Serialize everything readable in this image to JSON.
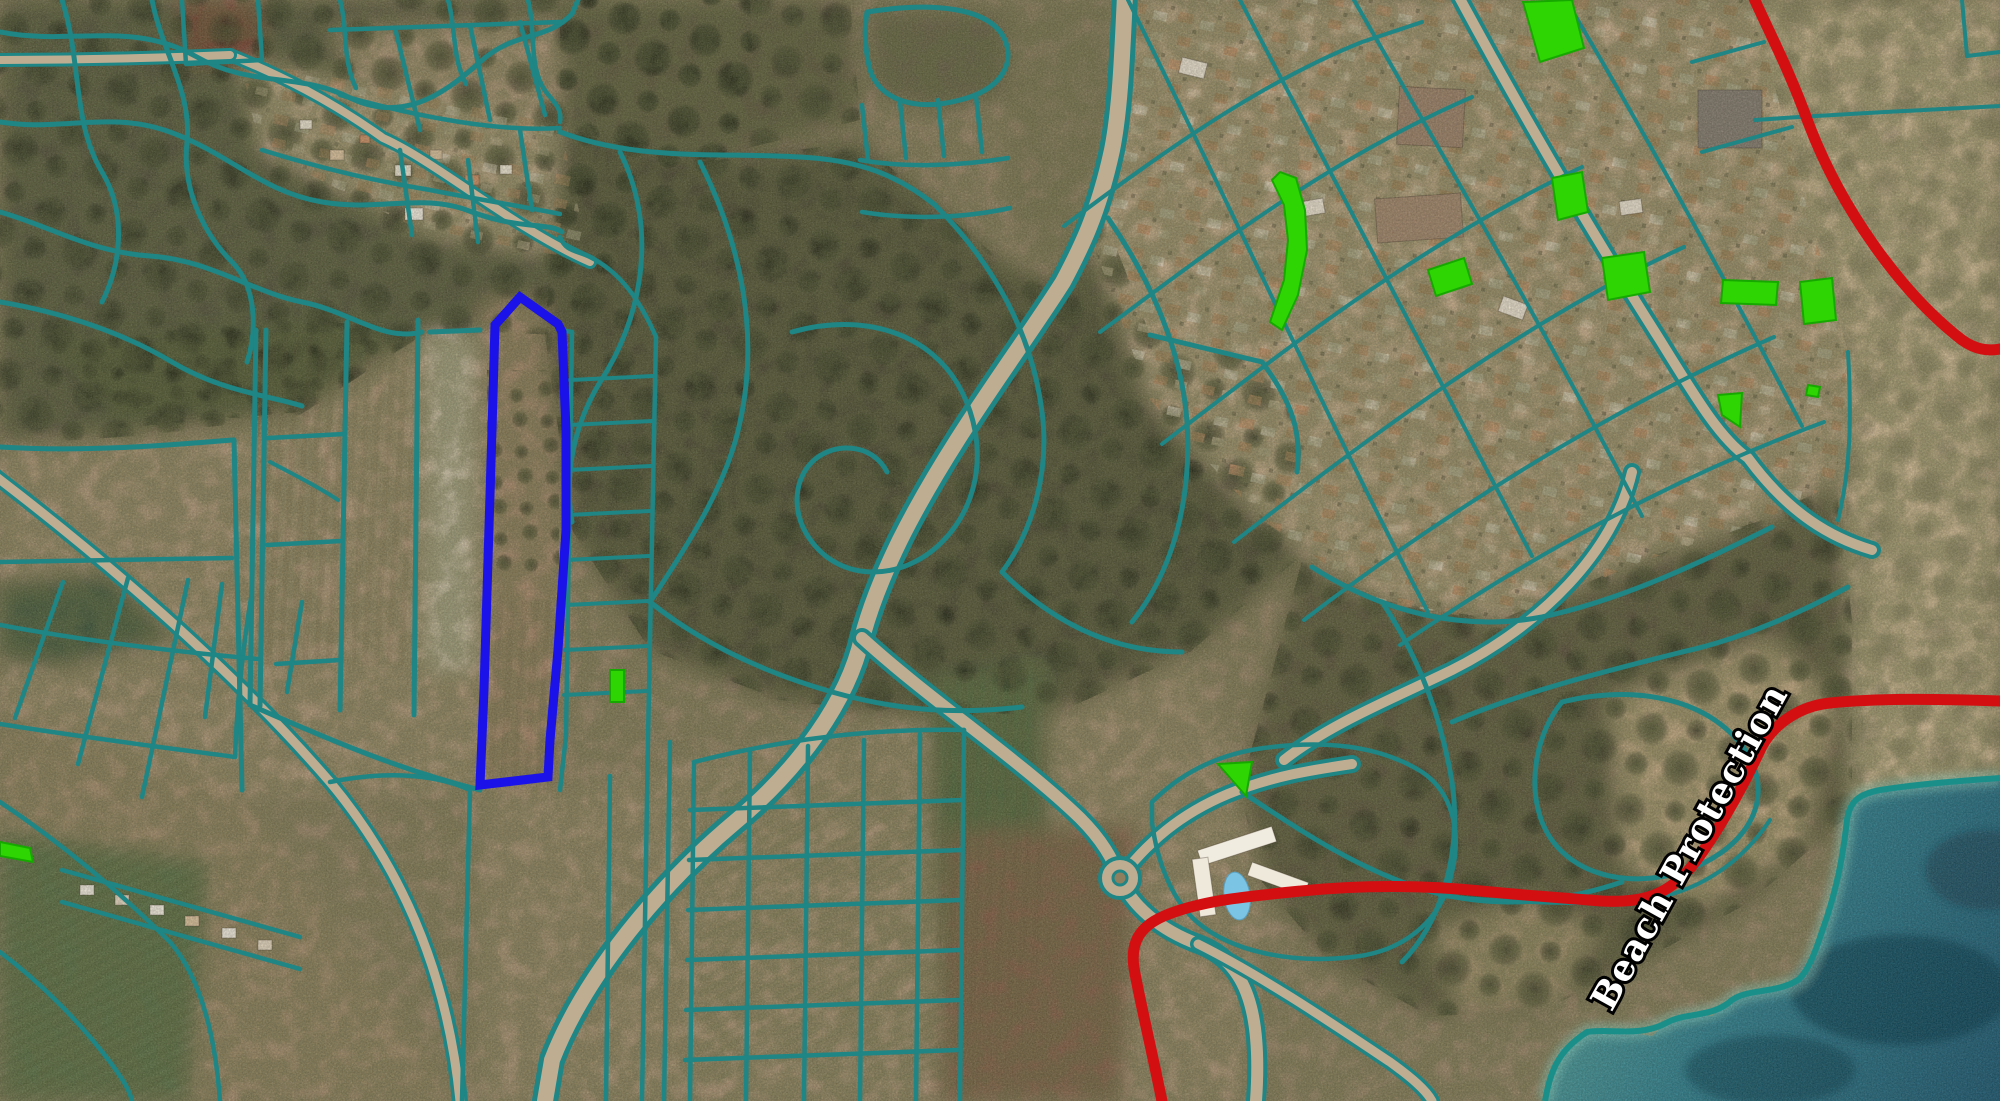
{
  "map": {
    "type": "cadastral-satellite-view",
    "labels": [
      {
        "text": "Beach Protection",
        "color": "#ffffff",
        "outline": "#000000",
        "rotation_deg": -61
      }
    ],
    "colors": {
      "parcel_boundary": "#1f8585",
      "selected_parcel_outline": "#1a12e8",
      "highlight_parcel_fill": "#2ed503",
      "highlight_parcel_stroke": "#17a800",
      "protection_line": "#d40f12",
      "sea_shallow": "#5aa89e",
      "sea_deep": "#1c5870",
      "road_fill": "#bfad92"
    },
    "selected_parcel": {
      "points": "520,297 558,324 562,332 566,430 566,530 558,650 550,740 548,777 480,785 484,690 488,560 492,430 495,325"
    },
    "green_parcels": [
      "1523,2 1572,0 1584,48 1540,62",
      "1280,172 1296,178 1305,210 1307,250 1298,295 1282,330 1270,322 1284,280 1288,240 1284,205 1272,180",
      "1552,178 1582,172 1588,212 1558,220",
      "1428,270 1464,258 1472,284 1436,296",
      "1602,258 1644,252 1650,292 1608,300",
      "1723,280 1778,282 1776,305 1721,303",
      "1800,282 1832,278 1836,320 1804,324",
      "1718,395 1742,393 1740,427 1722,415",
      "1808,385 1820,387 1818,397 1806,395",
      "1218,764 1252,762 1246,796",
      "610,670 624,670 624,702 610,702",
      "0,842 30,848 33,862 0,856"
    ],
    "protection_line": {
      "paths": [
        "M1752,-6 C1772,38 1790,72 1808,122 C1840,207 1900,292 1962,340 C1976,350 1988,351 2000,349",
        "M1163,1106 C1150,1042 1140,1002 1134,968 C1130,941 1141,926 1164,916 C1200,901 1241,897 1301,891 C1361,885 1421,885 1481,891 C1521,895 1561,898 1601,901 C1641,903 1669,897 1696,861 C1720,828 1741,791 1762,746 C1775,723 1800,706 1830,703 C1880,698 1940,699 2000,701"
      ]
    }
  }
}
